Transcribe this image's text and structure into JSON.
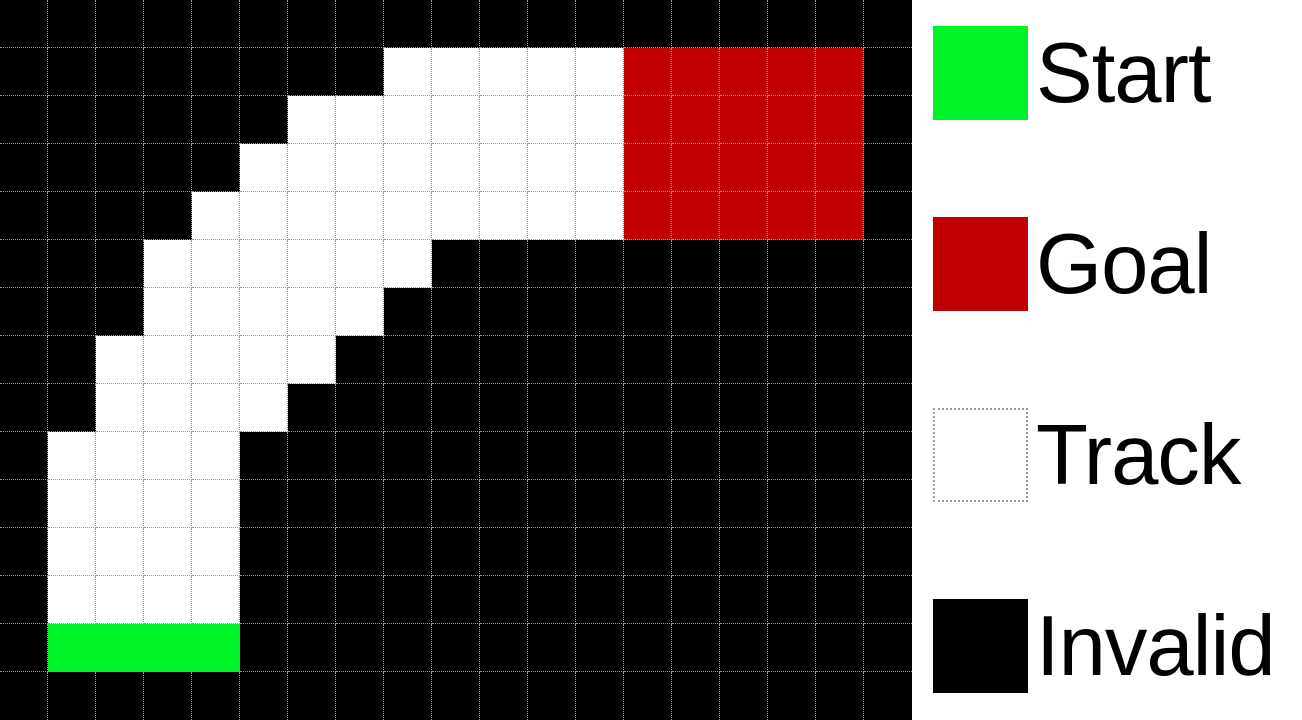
{
  "colors": {
    "start": "#00F228",
    "goal": "#C00000",
    "track": "#FFFFFF",
    "invalid": "#000000",
    "gridline": "#999999",
    "legend_background": "#FFFFFF",
    "legend_text": "#000000"
  },
  "grid": {
    "rows": 15,
    "cols": 19,
    "cell_key": {
      ".": "invalid",
      "T": "track",
      "S": "start",
      "G": "goal"
    },
    "map": [
      "...................",
      "........TTTTTGGGGG.",
      "......TTTTTTTGGGGG.",
      ".....TTTTTTTTGGGGG.",
      "....TTTTTTTTTGGGGG.",
      "...TTTTTT..........",
      "...TTTTT...........",
      "..TTTTT............",
      "..TTTT.............",
      ".TTTT..............",
      ".TTTT..............",
      ".TTTT..............",
      ".TTTT..............",
      ".SSSS..............",
      "..................."
    ]
  },
  "legend": {
    "items": [
      {
        "label": "Start",
        "type": "start"
      },
      {
        "label": "Goal",
        "type": "goal"
      },
      {
        "label": "Track",
        "type": "track"
      },
      {
        "label": "Invalid",
        "type": "invalid"
      }
    ]
  }
}
